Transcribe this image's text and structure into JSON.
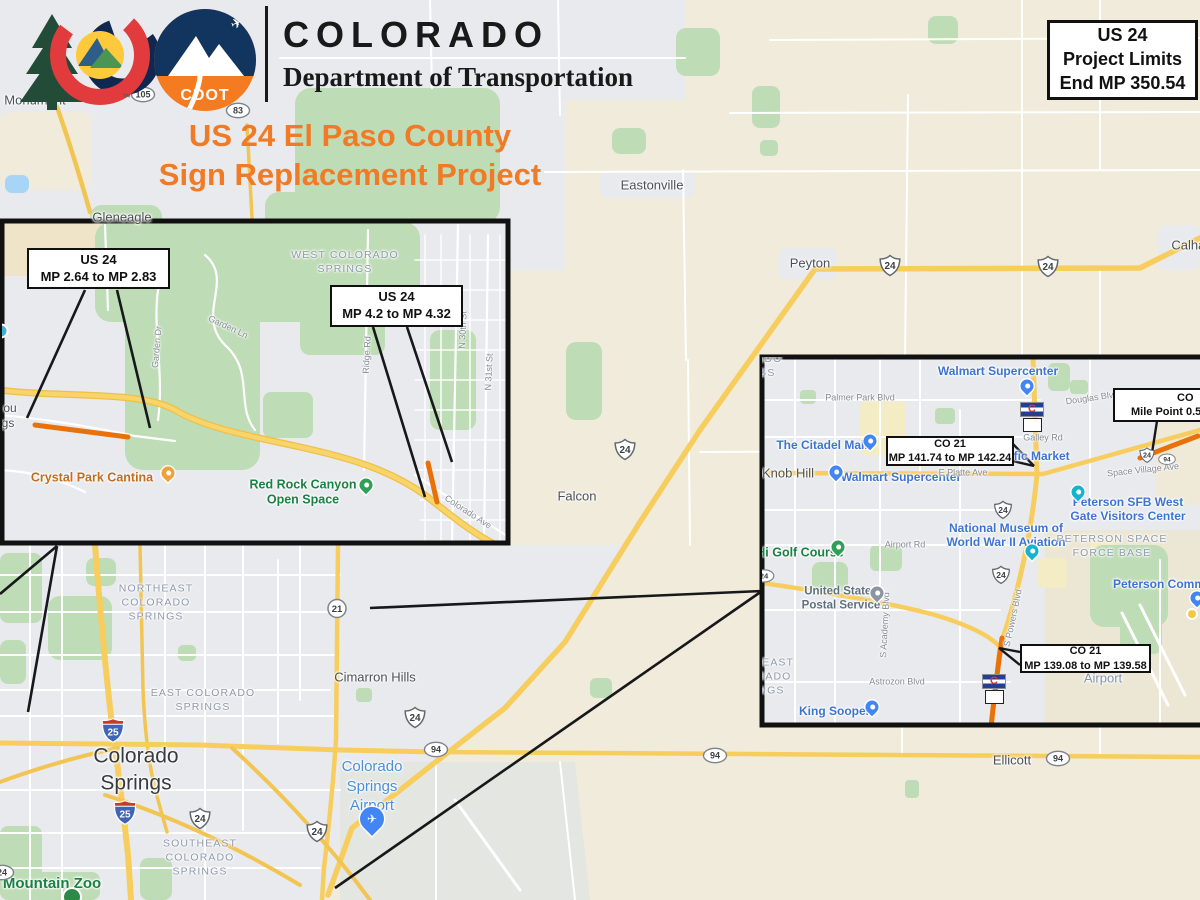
{
  "header": {
    "brand_title": "COLORADO",
    "brand_subtitle": "Department of Transportation",
    "cdot_badge_text": "CDOT",
    "trademark": "™",
    "project_title_line1": "US 24 El Paso County",
    "project_title_line2": "Sign Replacement Project"
  },
  "limits_box": {
    "line1": "US 24",
    "line2": "Project Limits",
    "line3": "End MP 350.54"
  },
  "colors": {
    "title_orange": "#f07b27",
    "map_beige": "#f0ebdb",
    "map_gray": "#e8eaee",
    "park_green": "#bedcb6",
    "road_yellow": "#f7cd5d",
    "highlight_orange": "#e8710a",
    "water_blue": "#a6d5f5",
    "poi_blue": "#3e74d1",
    "poi_green": "#1b8143",
    "area_label_gray": "#8e99ab",
    "callout_border": "#101010"
  },
  "labels": [
    {
      "layer": "main",
      "x": 35,
      "y": 100,
      "cls": "town",
      "text": "Monument",
      "name": "label-monument"
    },
    {
      "layer": "main",
      "x": 122,
      "y": 217,
      "cls": "town",
      "text": "Gleneagle",
      "name": "label-gleneagle"
    },
    {
      "layer": "main",
      "x": 652,
      "y": 185,
      "cls": "town",
      "text": "Eastonville",
      "name": "label-eastonville"
    },
    {
      "layer": "main",
      "x": 810,
      "y": 263,
      "cls": "town",
      "text": "Peyton",
      "name": "label-peyton"
    },
    {
      "layer": "main",
      "x": 1192,
      "y": 245,
      "cls": "town",
      "text": "Calhan",
      "name": "label-calhan"
    },
    {
      "layer": "main",
      "x": 577,
      "y": 496,
      "cls": "town",
      "text": "Falcon",
      "name": "label-falcon"
    },
    {
      "layer": "main",
      "x": 375,
      "y": 677,
      "cls": "town",
      "text": "Cimarron Hills",
      "name": "label-cimarron-hills"
    },
    {
      "layer": "main",
      "x": 1012,
      "y": 760,
      "cls": "town",
      "text": "Ellicott",
      "name": "label-ellicott"
    },
    {
      "layer": "main",
      "x": 136,
      "y": 770,
      "cls": "city-lg",
      "lines": [
        "Colorado",
        "Springs"
      ],
      "name": "label-colorado-springs"
    },
    {
      "layer": "main",
      "x": 156,
      "y": 603,
      "cls": "area",
      "lines": [
        "NORTHEAST",
        "COLORADO",
        "SPRINGS"
      ],
      "name": "label-northeast-colorado-springs"
    },
    {
      "layer": "main",
      "x": 203,
      "y": 700,
      "cls": "area",
      "lines": [
        "EAST COLORADO",
        "SPRINGS"
      ],
      "name": "label-east-colorado-springs"
    },
    {
      "layer": "main",
      "x": 200,
      "y": 858,
      "cls": "area",
      "lines": [
        "SOUTHEAST",
        "COLORADO",
        "SPRINGS"
      ],
      "name": "label-southeast-colorado-springs"
    },
    {
      "layer": "main",
      "x": 372,
      "y": 786,
      "cls": "poi-airport",
      "lines": [
        "Colorado",
        "Springs",
        "Airport"
      ],
      "name": "label-colorado-springs-airport"
    },
    {
      "layer": "main",
      "x": 52,
      "y": 884,
      "cls": "poi-green-lg",
      "text": "Mountain Zoo",
      "name": "label-mountain-zoo"
    },
    {
      "layer": "left",
      "x": 345,
      "y": 262,
      "cls": "area",
      "lines": [
        "WEST COLORADO",
        "SPRINGS"
      ],
      "name": "label-west-colorado-springs"
    },
    {
      "layer": "left",
      "x": 92,
      "y": 478,
      "cls": "poi-orange",
      "text": "Crystal Park Cantina",
      "name": "label-crystal-park-cantina"
    },
    {
      "layer": "left",
      "x": 303,
      "y": 492,
      "cls": "poi-green",
      "lines": [
        "Red Rock Canyon",
        "Open Space"
      ],
      "name": "label-red-rock-canyon"
    },
    {
      "layer": "left",
      "x": 10,
      "y": 408,
      "cls": "frag",
      "text": "ou",
      "name": "label-fragment-ou"
    },
    {
      "layer": "left",
      "x": 8,
      "y": 423,
      "cls": "frag",
      "text": "gs",
      "name": "label-fragment-gs"
    },
    {
      "layer": "left",
      "x": 228,
      "y": 327,
      "cls": "street",
      "rot": 25,
      "text": "Garden Ln",
      "name": "label-garden-ln"
    },
    {
      "layer": "left",
      "x": 157,
      "y": 347,
      "cls": "street",
      "rot": -85,
      "text": "Garden Dr",
      "name": "label-garden-dr"
    },
    {
      "layer": "left",
      "x": 367,
      "y": 355,
      "cls": "street",
      "rot": -87,
      "text": "Ridge Rd",
      "name": "label-ridge-rd"
    },
    {
      "layer": "left",
      "x": 463,
      "y": 330,
      "cls": "street",
      "rot": -87,
      "text": "N 30th St",
      "name": "label-n30th-st"
    },
    {
      "layer": "left",
      "x": 489,
      "y": 372,
      "cls": "street",
      "rot": -87,
      "text": "N 31st St",
      "name": "label-n31st-st"
    },
    {
      "layer": "left",
      "x": 468,
      "y": 512,
      "cls": "street",
      "rot": 33,
      "text": "Colorado Ave",
      "name": "label-colorado-ave"
    },
    {
      "layer": "right",
      "x": 748,
      "y": 366,
      "cls": "area",
      "lines": [
        "COLORADO",
        "SPRINGS"
      ],
      "name": "label-colorado-springs-inset"
    },
    {
      "layer": "right",
      "x": 998,
      "y": 371,
      "cls": "poi-blue",
      "text": "Walmart Supercenter",
      "name": "label-walmart-1"
    },
    {
      "layer": "right",
      "x": 822,
      "y": 445,
      "cls": "poi-blue",
      "text": "The Citadel Mall",
      "name": "label-citadel-mall"
    },
    {
      "layer": "right",
      "x": 901,
      "y": 477,
      "cls": "poi-blue",
      "text": "Walmart Supercenter",
      "name": "label-walmart-2"
    },
    {
      "layer": "right",
      "x": 1040,
      "y": 456,
      "cls": "poi-blue",
      "text": "ific Market",
      "name": "label-pacific-market"
    },
    {
      "layer": "right",
      "x": 788,
      "y": 473,
      "cls": "town",
      "text": "Knob Hill",
      "name": "label-knob-hill"
    },
    {
      "layer": "right",
      "x": 1128,
      "y": 509,
      "cls": "poi-blue",
      "lines": [
        "Peterson SFB West",
        "Gate Visitors Center"
      ],
      "name": "label-peterson-gate"
    },
    {
      "layer": "right",
      "x": 1006,
      "y": 535,
      "cls": "poi-blue",
      "lines": [
        "National Museum of",
        "World War II Aviation"
      ],
      "name": "label-ww2-museum"
    },
    {
      "layer": "right",
      "x": 1112,
      "y": 546,
      "cls": "area",
      "lines": [
        "PETERSON SPACE",
        "FORCE BASE"
      ],
      "name": "label-peterson-space-force"
    },
    {
      "layer": "right",
      "x": 800,
      "y": 553,
      "cls": "poi-green",
      "text": "Hi Golf Course",
      "name": "label-golf-course"
    },
    {
      "layer": "right",
      "x": 841,
      "y": 599,
      "cls": "poi-gray",
      "lines": [
        "United States",
        "Postal Service"
      ],
      "name": "label-usps"
    },
    {
      "layer": "right",
      "x": 1164,
      "y": 584,
      "cls": "poi-blue",
      "text": "Peterson Commis",
      "name": "label-peterson-commissary"
    },
    {
      "layer": "right",
      "x": 757,
      "y": 677,
      "cls": "area",
      "lines": [
        "SOUTHEAST",
        "COLORADO",
        "SPRINGS"
      ],
      "name": "label-southeast-inset"
    },
    {
      "layer": "right",
      "x": 838,
      "y": 711,
      "cls": "poi-blue",
      "text": "King Soopers",
      "name": "label-king-soopers"
    },
    {
      "layer": "right",
      "x": 1103,
      "y": 678,
      "cls": "area-blue",
      "text": "Airport",
      "name": "label-airport-area"
    },
    {
      "layer": "right",
      "x": 860,
      "y": 398,
      "cls": "street",
      "text": "Palmer Park Blvd",
      "name": "label-palmer-park-blvd"
    },
    {
      "layer": "right",
      "x": 1092,
      "y": 398,
      "cls": "street",
      "rot": -8,
      "text": "Douglas Blvd",
      "name": "label-douglas-blvd"
    },
    {
      "layer": "right",
      "x": 1043,
      "y": 438,
      "cls": "street",
      "text": "Galley Rd",
      "name": "label-galley-rd"
    },
    {
      "layer": "right",
      "x": 963,
      "y": 473,
      "cls": "street",
      "text": "E Platte Ave",
      "name": "label-e-platte-ave"
    },
    {
      "layer": "right",
      "x": 1143,
      "y": 470,
      "cls": "street",
      "rot": -6,
      "text": "Space Village Ave",
      "name": "label-space-village-ave"
    },
    {
      "layer": "right",
      "x": 905,
      "y": 545,
      "cls": "street",
      "text": "Airport Rd",
      "name": "label-airport-rd"
    },
    {
      "layer": "right",
      "x": 897,
      "y": 682,
      "cls": "street",
      "text": "Astrozon Blvd",
      "name": "label-astrozon-blvd"
    },
    {
      "layer": "right",
      "x": 885,
      "y": 625,
      "cls": "street",
      "rot": -87,
      "text": "S Academy Blvd",
      "name": "label-s-academy-blvd"
    },
    {
      "layer": "right",
      "x": 1013,
      "y": 618,
      "cls": "street",
      "rot": -78,
      "text": "S Powers Blvd",
      "name": "label-s-powers-blvd"
    }
  ],
  "shields": [
    {
      "layer": "main",
      "type": "oval",
      "num": "105",
      "x": 143,
      "y": 97
    },
    {
      "layer": "main",
      "type": "oval",
      "num": "83",
      "x": 238,
      "y": 113
    },
    {
      "layer": "main",
      "type": "us",
      "num": "24",
      "x": 890,
      "y": 268
    },
    {
      "layer": "main",
      "type": "us",
      "num": "24",
      "x": 1048,
      "y": 269
    },
    {
      "layer": "main",
      "type": "us",
      "num": "24",
      "x": 625,
      "y": 452
    },
    {
      "layer": "main",
      "type": "circle",
      "num": "21",
      "x": 337,
      "y": 611
    },
    {
      "layer": "main",
      "type": "us",
      "num": "24",
      "x": 415,
      "y": 720
    },
    {
      "layer": "main",
      "type": "oval",
      "num": "94",
      "x": 436,
      "y": 752
    },
    {
      "layer": "main",
      "type": "oval",
      "num": "94",
      "x": 715,
      "y": 758
    },
    {
      "layer": "main",
      "type": "oval",
      "num": "94",
      "x": 1058,
      "y": 761
    },
    {
      "layer": "main",
      "type": "i25",
      "num": "25",
      "x": 113,
      "y": 733
    },
    {
      "layer": "main",
      "type": "i25",
      "num": "25",
      "x": 125,
      "y": 815
    },
    {
      "layer": "main",
      "type": "us",
      "num": "24",
      "x": 200,
      "y": 821
    },
    {
      "layer": "main",
      "type": "us",
      "num": "24",
      "x": 317,
      "y": 834
    },
    {
      "layer": "main",
      "type": "oval",
      "num": "24",
      "x": 2,
      "y": 875
    },
    {
      "layer": "right",
      "type": "flag21",
      "num": "21",
      "x": 1032,
      "y": 417
    },
    {
      "layer": "right",
      "type": "us",
      "num": "24",
      "x": 1003,
      "y": 512,
      "scale": 0.85
    },
    {
      "layer": "right",
      "type": "us",
      "num": "24",
      "x": 1001,
      "y": 577,
      "scale": 0.85
    },
    {
      "layer": "right",
      "type": "oval",
      "num": "24",
      "x": 764,
      "y": 578,
      "scale": 0.85
    },
    {
      "layer": "right",
      "type": "us",
      "num": "24",
      "x": 1147,
      "y": 457,
      "scale": 0.72
    },
    {
      "layer": "right",
      "type": "oval",
      "num": "94",
      "x": 1167,
      "y": 461,
      "scale": 0.72
    },
    {
      "layer": "right",
      "type": "flag21",
      "num": "21",
      "x": 994,
      "y": 689
    }
  ],
  "pins": [
    {
      "layer": "main",
      "type": "plane",
      "x": 372,
      "y": 828,
      "glyph": "✈",
      "name": "airport-plane-pin"
    },
    {
      "layer": "main",
      "type": "zoo",
      "x": 72,
      "y": 897,
      "name": "zoo-pin"
    },
    {
      "layer": "left",
      "type": "orange",
      "x": 168,
      "y": 478,
      "name": "restaurant-pin"
    },
    {
      "layer": "left",
      "type": "green",
      "x": 366,
      "y": 490,
      "name": "hiker-pin"
    },
    {
      "layer": "left",
      "type": "tealdot",
      "x": 1,
      "y": 331,
      "name": "teal-dot"
    },
    {
      "layer": "right",
      "type": "blue",
      "x": 1027,
      "y": 391,
      "name": "walmart-pin-1"
    },
    {
      "layer": "right",
      "type": "blue",
      "x": 870,
      "y": 446,
      "name": "citadel-pin"
    },
    {
      "layer": "right",
      "type": "blue",
      "x": 836,
      "y": 477,
      "name": "walmart-pin-2"
    },
    {
      "layer": "right",
      "type": "teal",
      "x": 1078,
      "y": 497,
      "name": "visitor-center-pin"
    },
    {
      "layer": "right",
      "type": "teal",
      "x": 1032,
      "y": 556,
      "name": "museum-pin"
    },
    {
      "layer": "right",
      "type": "gray",
      "x": 877,
      "y": 598,
      "name": "usps-pin"
    },
    {
      "layer": "right",
      "type": "green",
      "x": 838,
      "y": 552,
      "name": "golf-pin"
    },
    {
      "layer": "right",
      "type": "blue",
      "x": 872,
      "y": 712,
      "name": "king-soopers-pin"
    },
    {
      "layer": "right",
      "type": "blue",
      "x": 1197,
      "y": 603,
      "name": "commissary-pin"
    },
    {
      "layer": "right",
      "type": "yellowdot",
      "x": 1192,
      "y": 614,
      "name": "yellow-dot"
    }
  ],
  "callouts": [
    {
      "layer": "left",
      "x": 27,
      "y": 248,
      "w": 143,
      "h": 41,
      "cls": "big",
      "line1": "US 24",
      "line2": "MP 2.64 to MP 2.83",
      "name": "callout-us24-mp264"
    },
    {
      "layer": "left",
      "x": 330,
      "y": 285,
      "w": 133,
      "h": 42,
      "cls": "big",
      "line1": "US 24",
      "line2": "MP 4.2 to MP 4.32",
      "name": "callout-us24-mp42"
    },
    {
      "layer": "right",
      "x": 886,
      "y": 436,
      "w": 128,
      "h": 30,
      "cls": "small",
      "line1": "CO 21",
      "line2": "MP 141.74 to MP 142.24",
      "name": "callout-co21-mp141"
    },
    {
      "layer": "right",
      "x": 1020,
      "y": 644,
      "w": 131,
      "h": 29,
      "cls": "small",
      "line1": "CO 21",
      "line2": "MP 139.08 to MP 139.58",
      "name": "callout-co21-mp139"
    },
    {
      "layer": "right",
      "x": 1113,
      "y": 388,
      "w": 190,
      "h": 34,
      "cls": "small co-cut",
      "line1": "CO",
      "line2": "Mile Point 0.5",
      "pad1": 62,
      "pad2": 16,
      "name": "callout-co-milepoint"
    }
  ]
}
